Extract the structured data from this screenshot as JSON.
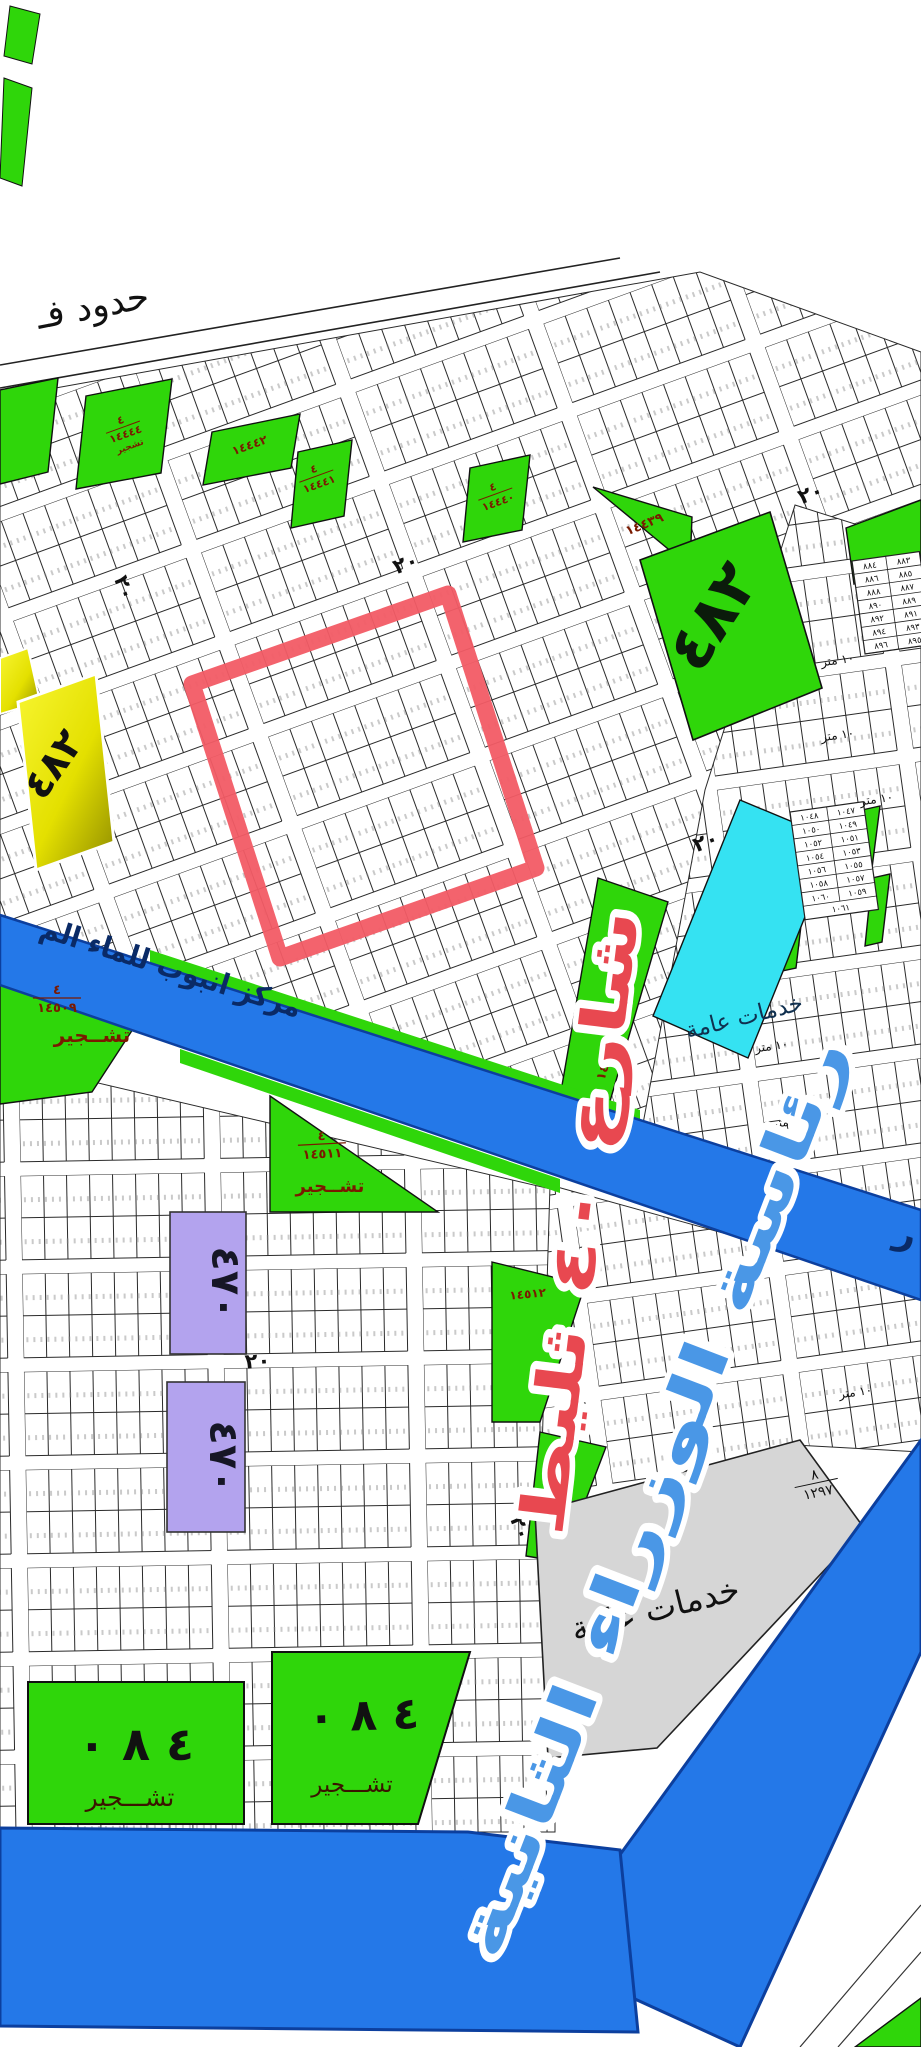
{
  "map": {
    "boundary_text": "حدود فـ",
    "overlays": {
      "street_red": "شارع ٤٠ ثليط",
      "landmark_blue": "رئاسة الوزراء الثانية",
      "pipeline": "مركز انبوب للماء الم",
      "pipeline_edge_letter": "ر"
    },
    "street_marks": {
      "w20": "٢٠",
      "w10": "١٠ متر",
      "w6": "٦ متر"
    },
    "parcels": {
      "block_yellow_482": "٤٨٢",
      "block_green_482": "٤٨٢",
      "block_purple_470_top": "٤٧٠",
      "block_purple_470_bottom": "٤٧٠",
      "block_480_left": {
        "no": "٤ ٨ ٠",
        "use": "تشـــجير"
      },
      "block_480_mid": {
        "no": "٤ ٨ ٠",
        "use": "تشـــجير"
      },
      "services_gray": {
        "label": "خدمات عامة",
        "plan_num": "٨",
        "plan_den": "١٢٩٧"
      },
      "services_cyan": {
        "label": "خدمات عامة"
      },
      "greens": {
        "g14444": {
          "num": "٤",
          "den": "١٤٤٤٤",
          "use": "تشجير"
        },
        "g14442": {
          "den": "١٤٤٤٢"
        },
        "g14441": {
          "num": "٤",
          "den": "١٤٤٤١"
        },
        "g14440": {
          "num": "٤",
          "den": "١٤٤٤٠"
        },
        "g14439": {
          "den": "١٤٤٣٩"
        },
        "g14438": {
          "den": "١٤٤٣٨"
        },
        "g14509": {
          "num": "٤",
          "den": "١٤٥٠٩",
          "use": "تشــجير"
        },
        "g14511": {
          "num": "٤",
          "den": "١٤٥١١",
          "use": "تشــجير"
        },
        "g14512": {
          "den": "١٤٥١٢"
        }
      }
    },
    "plot_blocks": {
      "block_880s": {
        "left_col": [
          "٨٨٤",
          "٨٨٦",
          "٨٨٨",
          "٨٩٠",
          "٨٩٢",
          "٨٩٤",
          "٨٩٦"
        ],
        "right_col": [
          "٨٨٣",
          "٨٨٥",
          "٨٨٧",
          "٨٨٩",
          "٨٩١",
          "٨٩٣",
          "٨٩٥"
        ]
      },
      "block_1050s": {
        "left_col": [
          "١٠٤٨",
          "١٠٥٠",
          "١٠٥٢",
          "١٠٥٤",
          "١٠٥٦",
          "١٠٥٨",
          "١٠٦٠"
        ],
        "right_col": [
          "١٠٤٧",
          "١٠٤٩",
          "١٠٥١",
          "١٠٥٣",
          "١٠٥٥",
          "١٠٥٧",
          "١٠٥٩"
        ],
        "footer": "١٠٦١"
      }
    },
    "colors": {
      "green": "#2fd60a",
      "cyan": "#35e2f2",
      "yellow": "#ece800",
      "purple": "#b3a3ee",
      "blue_band": "#2478e8",
      "blue_band_edge": "#0c3f9e",
      "gray": "#d6d6d6",
      "red_highlight": "#f25b65",
      "red_text": "#e84850",
      "blue_text": "#4a97e6",
      "pipeline_text": "#0a2a66",
      "maroon": "#7a1a00"
    }
  }
}
